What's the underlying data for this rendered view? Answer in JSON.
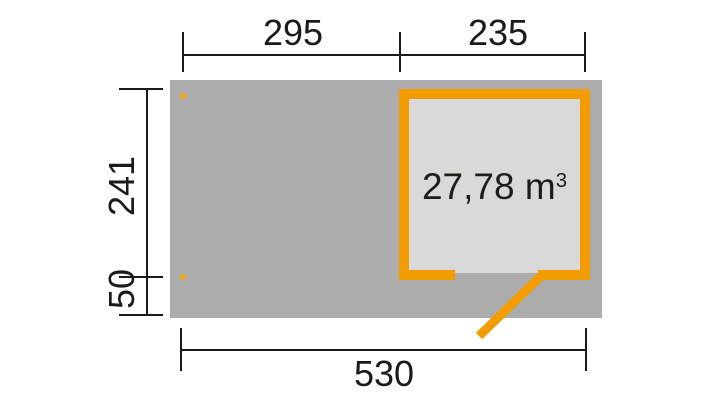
{
  "plan": {
    "volume": {
      "text": "27,78 m",
      "superscript": "3"
    },
    "dims": {
      "top_segment_left": "295",
      "top_segment_right": "235",
      "side_height": "241",
      "side_lower": "50",
      "bottom_total": "530"
    },
    "colors": {
      "accent_orange": "#F39C00",
      "dot_orange": "#F5A51C",
      "platform_gray": "#ACACAC",
      "interior_gray": "#D9D9D9",
      "line_black": "#1A1A1A",
      "background": "#FFFFFF"
    }
  }
}
